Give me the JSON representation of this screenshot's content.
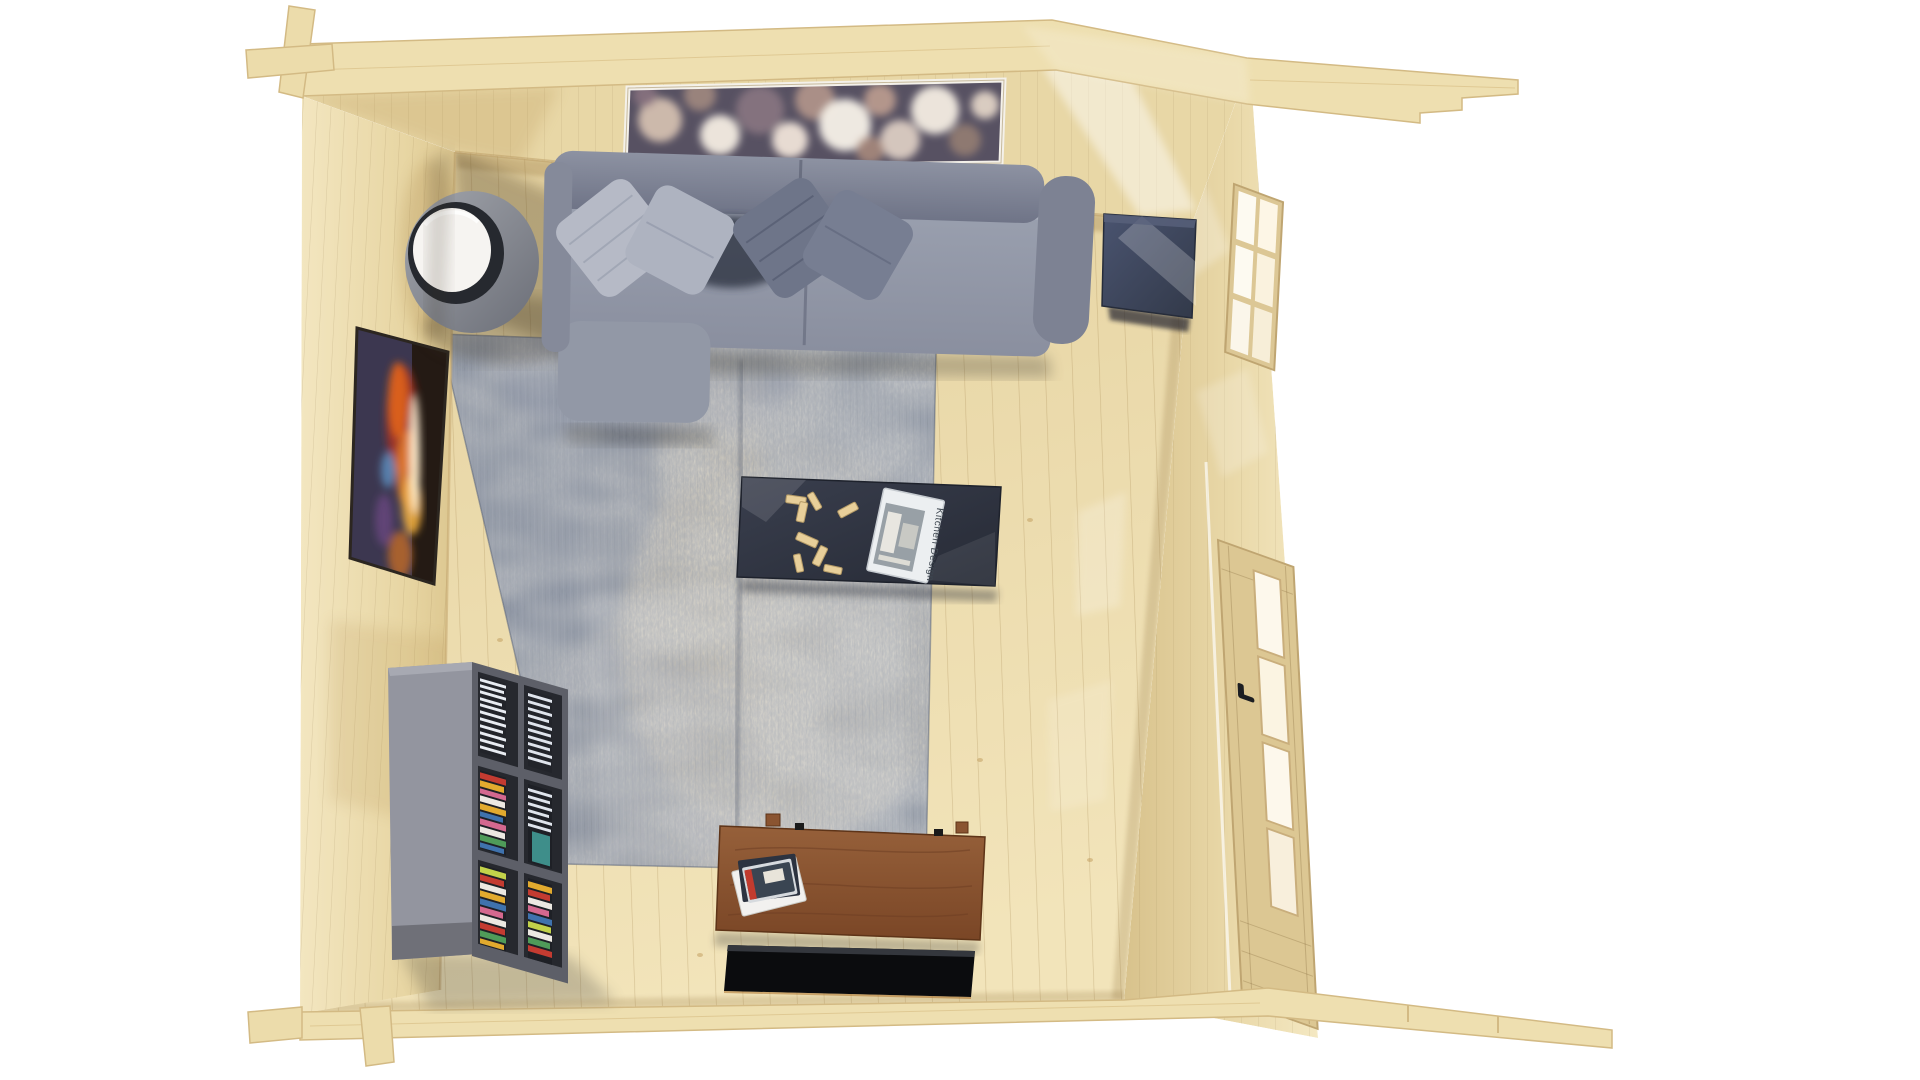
{
  "scene": {
    "subject": "Top-down 3D rendering of a log cabin living room interior",
    "style": "photoreal architectural visualization, bird's-eye view",
    "room": {
      "walls_material": "natural pine log boards",
      "floor_material": "light pine plank flooring",
      "roof_plates": "staggered pine beams extending right at top and bottom"
    },
    "furniture": [
      {
        "name": "sofa",
        "color": "#8e93a3",
        "pillow_count": 4,
        "pillow_colors": [
          "#b6bac6",
          "#aeb3c0",
          "#6e7589",
          "#777e92"
        ]
      },
      {
        "name": "round-side-table",
        "top_color": "#f6f4f1",
        "body_color": "#82868f"
      },
      {
        "name": "coffee-table",
        "color": "#2f3440",
        "items": [
          "scattered wooden game pieces",
          "kitchen magazine"
        ]
      },
      {
        "name": "navy-side-cabinet",
        "color": "#3b4257"
      },
      {
        "name": "bookshelf",
        "color": "#70727c",
        "contents": [
          "CD stacks",
          "colorful book stacks"
        ]
      },
      {
        "name": "tv-sideboard",
        "color": "#8a5431",
        "items": [
          "magazine stack"
        ]
      },
      {
        "name": "tv-panel",
        "color": "#0b0c0e"
      }
    ],
    "decor": [
      {
        "name": "bokeh-artwork",
        "wall": "north",
        "frame_color": "#f4f1ea",
        "description": "wide panorama of warm blurred bokeh circles"
      },
      {
        "name": "fire-artwork",
        "wall": "west",
        "description": "dark abstract art with orange flame and blue accents"
      },
      {
        "name": "area-rug",
        "style": "distressed vintage",
        "colors": [
          "#6f7b8e",
          "#b5afa2",
          "#98a0ab"
        ]
      }
    ],
    "openings": [
      {
        "name": "upper-window",
        "wall": "east",
        "panes": 6
      },
      {
        "name": "glazed-door",
        "wall": "east",
        "panes": 4,
        "handle_color": "#1c1e22"
      }
    ],
    "coffee_table_magazine": {
      "title": "Kitchen Design"
    },
    "palette": {
      "pine_light": "#f0e2b8",
      "pine_mid": "#e8d7a6",
      "pine_floor": "#ead9aa",
      "sofa_gray": "#8e93a3",
      "rug_blue": "#6f7b8e",
      "table_navy": "#2f3440",
      "wood_brown": "#8a5431",
      "tv_black": "#0b0c0e",
      "background": "#ffffff"
    }
  }
}
